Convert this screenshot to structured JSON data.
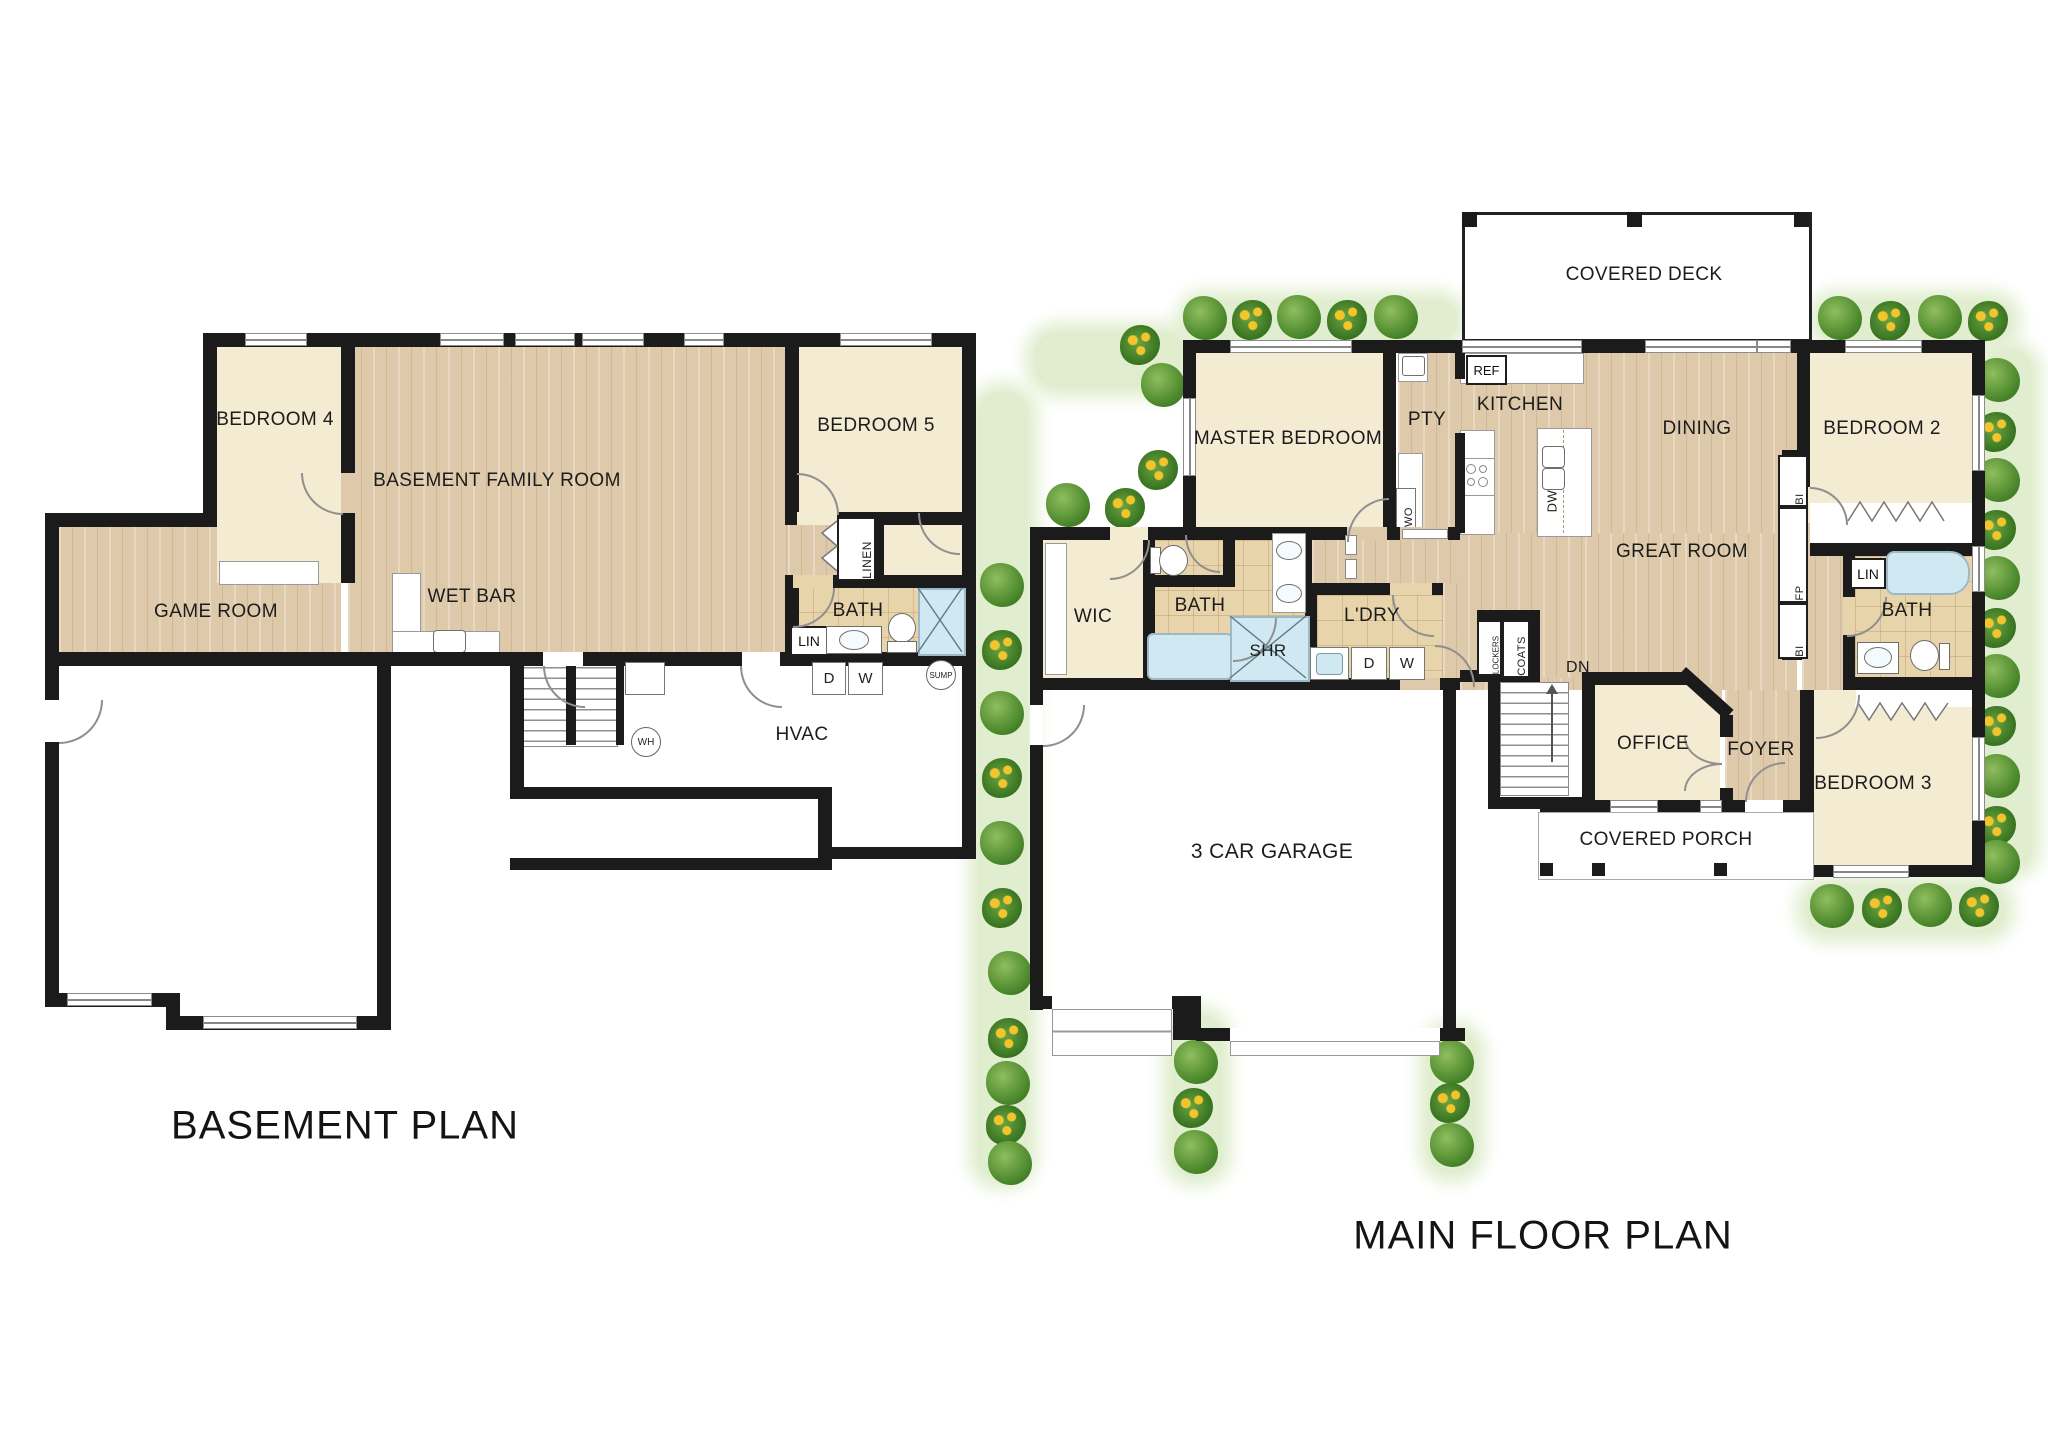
{
  "basement": {
    "title": "BASEMENT PLAN",
    "labels": {
      "bedroom4": "BEDROOM 4",
      "family_room": "BASEMENT FAMILY ROOM",
      "bedroom5": "BEDROOM 5",
      "game_room": "GAME ROOM",
      "wet_bar": "WET BAR",
      "linen": "LINEN",
      "bath": "BATH",
      "lin": "LIN",
      "hvac": "HVAC",
      "water_heater": "WH",
      "sump": "SUMP",
      "dryer": "D",
      "washer": "W"
    }
  },
  "main_floor": {
    "title": "MAIN FLOOR PLAN",
    "labels": {
      "covered_deck": "COVERED DECK",
      "master_bedroom": "MASTER BEDROOM",
      "pantry": "PTY",
      "fridge": "REF",
      "kitchen": "KITCHEN",
      "dining": "DINING",
      "great_room": "GREAT ROOM",
      "bedroom2": "BEDROOM 2",
      "wall_oven": "WO",
      "dishwasher": "DW",
      "wic": "WIC",
      "bath": "BATH",
      "shower": "SHR",
      "laundry": "L'DRY",
      "dryer": "D",
      "washer": "W",
      "builtin_top": "BI",
      "fireplace": "FP",
      "builtin_bottom": "BI",
      "lin": "LIN",
      "bath2": "BATH",
      "lockers": "LOCKERS",
      "coats": "COATS",
      "down": "DN",
      "office": "OFFICE",
      "foyer": "FOYER",
      "bedroom3": "BEDROOM 3",
      "covered_porch": "COVERED PORCH",
      "garage": "3 CAR GARAGE"
    }
  },
  "palette": {
    "wall": "#1b1b1b",
    "wood_floor": "#decaab",
    "tile_floor": "#e8d4aa",
    "room_cream": "#f3ebd2",
    "water_blue": "#cfe8f2",
    "landscape_green": "#e0eecf",
    "bush_green": "#4e8a2e",
    "flower_yellow": "#f2c52c"
  }
}
